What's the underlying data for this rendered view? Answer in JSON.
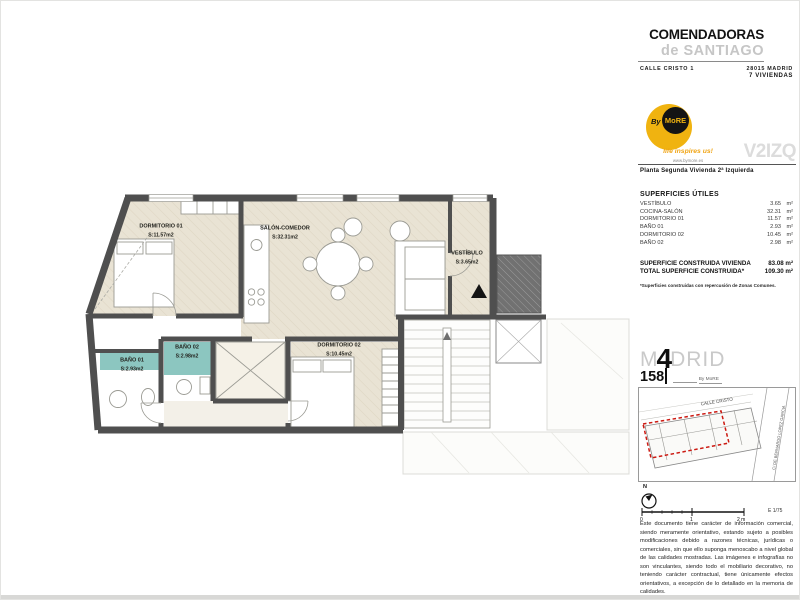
{
  "header": {
    "title": "COMENDADORAS",
    "subtitle": "de SANTIAGO",
    "address": "CALLE CRISTO 1",
    "postal_city": "28015 MADRID",
    "units_count": "7 VIVIENDAS"
  },
  "brand": {
    "by": "By",
    "name": "MoRE",
    "tagline": "life inspires us!",
    "website": "www.bymore.es"
  },
  "unit": {
    "code": "V2IZQ",
    "floor_desc": "Planta Segunda   Vivienda 2ª Izquierda"
  },
  "surfaces": {
    "title": "SUPERFICIES ÚTILES",
    "rows": [
      {
        "label": "VESTÍBULO",
        "value": "3.65",
        "unit": "m²"
      },
      {
        "label": "COCINA-SALÓN",
        "value": "32.31",
        "unit": "m²"
      },
      {
        "label": "DORMITORIO 01",
        "value": "11.57",
        "unit": "m²"
      },
      {
        "label": "BAÑO 01",
        "value": "2.93",
        "unit": "m²"
      },
      {
        "label": "DORMITORIO 02",
        "value": "10.45",
        "unit": "m²"
      },
      {
        "label": "BAÑO 02",
        "value": "2.98",
        "unit": "m²"
      }
    ]
  },
  "built": {
    "row1_label": "SUPERFICIE CONSTRUIDA VIVIENDA",
    "row1_value": "83.08 m²",
    "row2_label": "TOTAL SUPERFICIE CONSTRUIDA*",
    "row2_value": "109.30 m²",
    "footnote": "*Superficies construidas con repercusión de Zonas Comunes."
  },
  "madrid158": {
    "m": "M",
    "four": "4",
    "drid": "DRID",
    "number": "158",
    "by": "By  MoRE"
  },
  "map": {
    "street_top": "CALLE CRISTO",
    "street_right": "C/ DE BERNARDO LOPEZ GARCIA"
  },
  "compass": {
    "label": "N"
  },
  "scalebar": {
    "t0": "0",
    "t1": "1",
    "t2": "2 m",
    "ratio": "E 1/75"
  },
  "disclaimer": "Este documento tiene carácter de información comercial, siendo meramente orientativo, estando sujeto a posibles modificaciones debido a razones técnicas, jurídicas o comerciales, sin que ello suponga menoscabo a nivel global de las calidades mostradas. Las imágenes e infografías no son vinculantes, siendo todo el mobiliario decorativo, no teniendo carácter contractual, tiene únicamente efectos orientativos, a excepción de lo detallado en la memoria de calidades.",
  "plan": {
    "rooms": [
      {
        "name": "DORMITORIO 01",
        "area": "S:11.57m2"
      },
      {
        "name": "SALÓN-COMEDOR",
        "area": "S:32.31m2"
      },
      {
        "name": "VESTÍBULO",
        "area": "S:3.65m2"
      },
      {
        "name": "BAÑO 01",
        "area": "S:2.93m2"
      },
      {
        "name": "BAÑO 02",
        "area": "S:2.98m2"
      },
      {
        "name": "DORMITORIO 02",
        "area": "S:10.45m2"
      }
    ]
  },
  "colors": {
    "accent_yellow": "#f0b310",
    "bath_teal": "#8cc6c0",
    "wall_gray": "#4f4f4f",
    "floor_beige": "#e9e3d4",
    "map_red": "#cc1a12"
  }
}
